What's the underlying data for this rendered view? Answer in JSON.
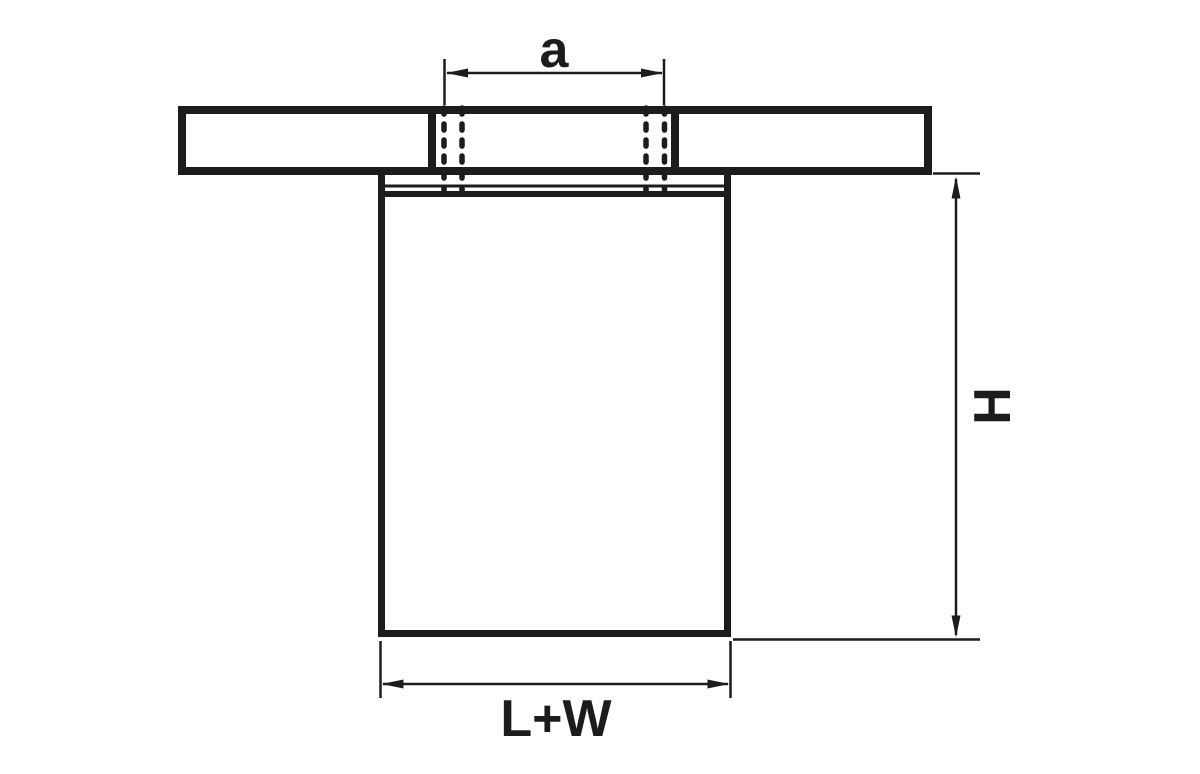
{
  "drawing": {
    "description_labels": {
      "hole_spacing": "a",
      "height": "H",
      "overall_width": "L+W"
    },
    "colors": {
      "line": "#1c1c1c",
      "background": "#ffffff"
    }
  }
}
